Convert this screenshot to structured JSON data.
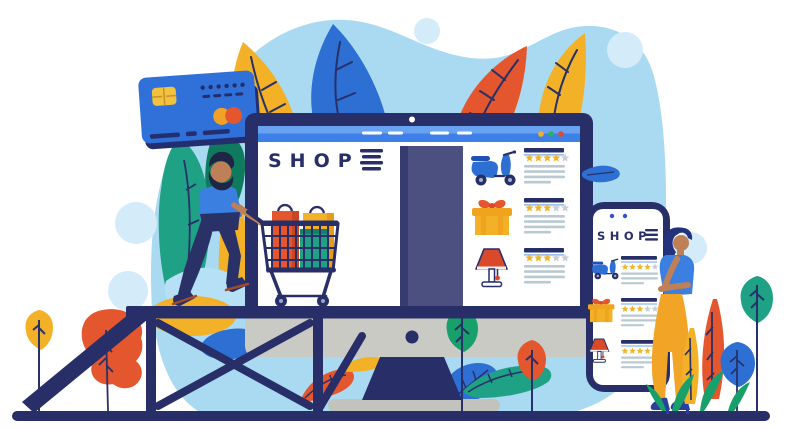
{
  "colors": {
    "navy": "#282e67",
    "blue": "#3b7fe0",
    "brightBlue": "#3d80e8",
    "barHighlight": "#69a2f0",
    "cardBlue": "#2f70d9",
    "leafBlue": "#2e6fd3",
    "bgBlob": "#a9daf2",
    "paleCircle": "#d4ecf9",
    "lightLeaf": "#b5e0f5",
    "yellow": "#f2b127",
    "orangeYellow": "#efa31e",
    "orange": "#e4562e",
    "red": "#d94a2b",
    "teal": "#1ea184",
    "green": "#18a06b",
    "darkGreen": "#0f7a5e",
    "slatePanel": "#4b5080",
    "chinGray": "#c9cac4",
    "baseGray": "#c2c3bd",
    "skin": "#c08057",
    "starYellow": "#f0b42c",
    "starGray": "#c9cdd8",
    "lineGray": "#b9c9d2",
    "pantsYellow": "#f2a427",
    "jeans": "#2a3166",
    "heelBlue": "#2c3f9e",
    "manHair": "#1e2547",
    "womanHair": "#22327c",
    "white": "#ffffff"
  },
  "monitor": {
    "shop_title": "SHOP",
    "window_dots": [
      "#f2b127",
      "#2eae5e",
      "#e04b2f"
    ],
    "products": [
      {
        "icon": "scooter-icon",
        "name": "scooter",
        "rating": 4,
        "max_stars": 5,
        "text_lines": 4
      },
      {
        "icon": "gift-icon",
        "name": "gift box",
        "rating": 3,
        "max_stars": 5,
        "text_lines": 4
      },
      {
        "icon": "lamp-icon",
        "name": "table lamp",
        "rating": 3,
        "max_stars": 5,
        "text_lines": 4
      }
    ]
  },
  "phone": {
    "shop_title": "SHOP",
    "products": [
      {
        "icon": "scooter-icon",
        "name": "scooter",
        "rating": 4,
        "max_stars": 5,
        "text_lines": 3
      },
      {
        "icon": "gift-icon",
        "name": "gift box",
        "rating": 3,
        "max_stars": 5,
        "text_lines": 3
      },
      {
        "icon": "lamp-icon",
        "name": "table lamp",
        "rating": 4,
        "max_stars": 5,
        "text_lines": 3
      }
    ]
  },
  "illustration_elements": [
    "credit-card",
    "man-shopper-with-cart",
    "desktop-monitor",
    "shopping-cart",
    "truss-bridge",
    "smartphone",
    "woman-browsing",
    "leaves",
    "plants"
  ]
}
